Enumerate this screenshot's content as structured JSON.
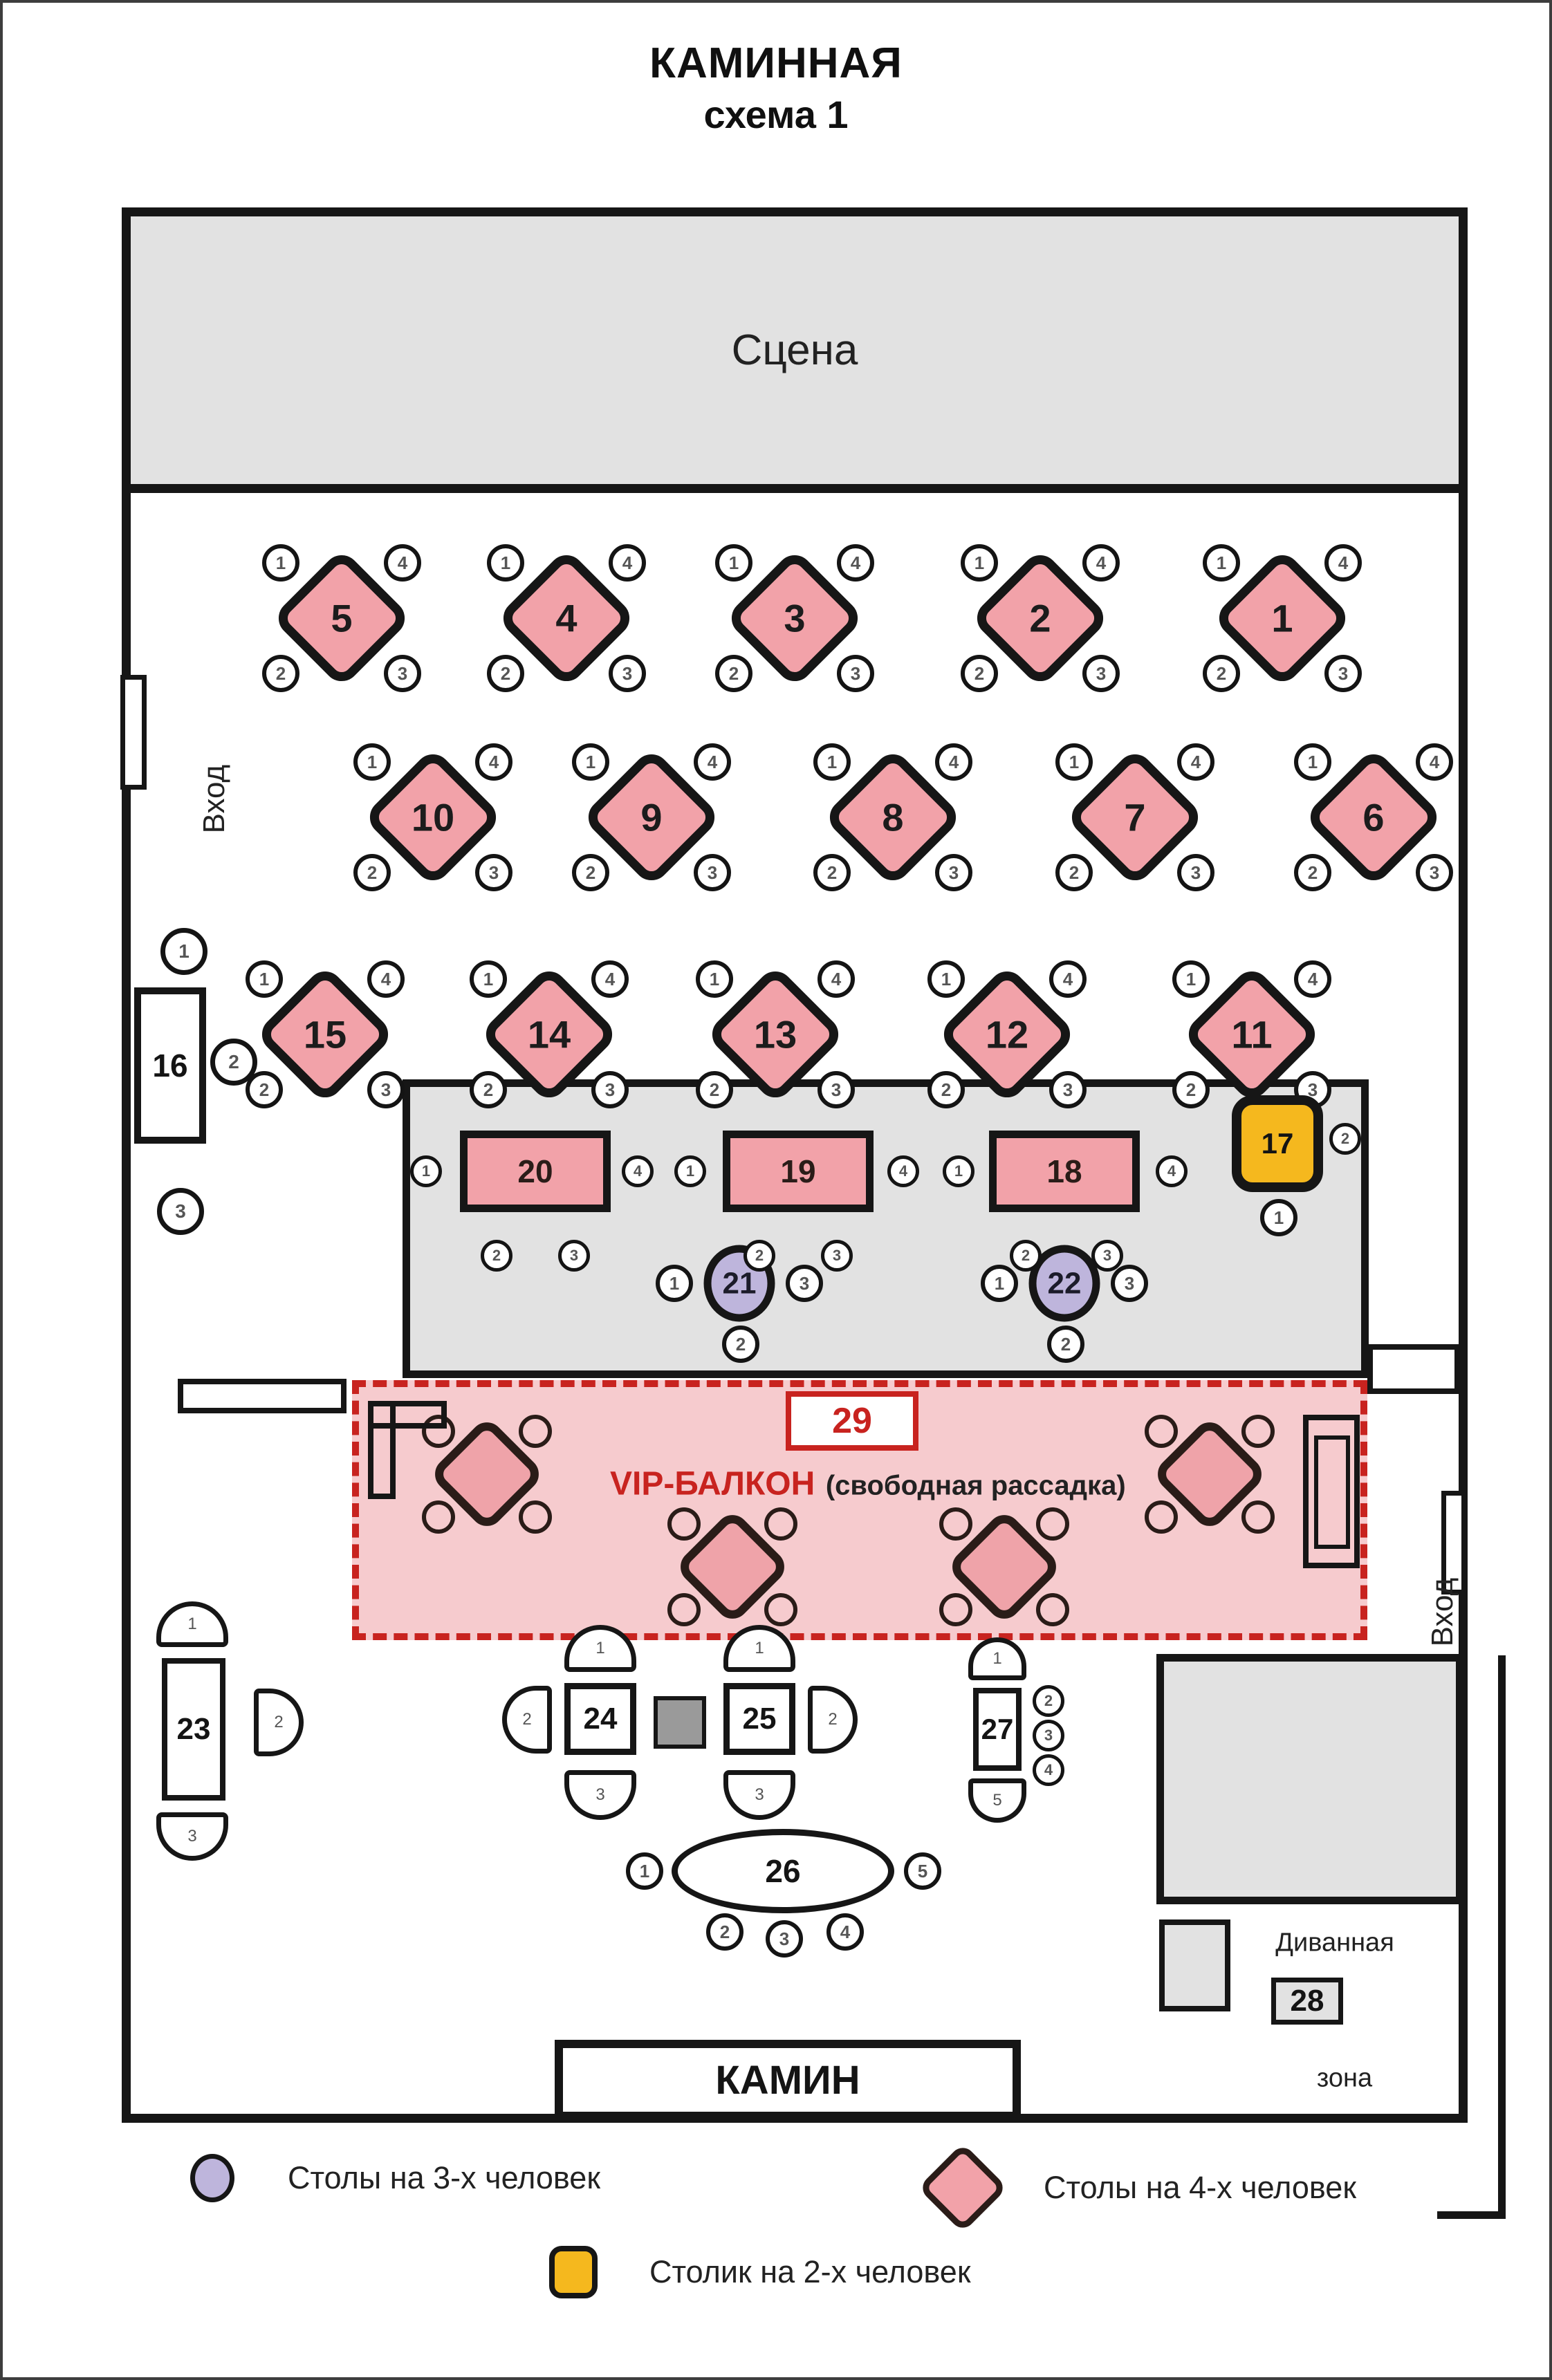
{
  "title": {
    "line1": "КАМИННАЯ",
    "line2": "схема 1"
  },
  "stage": {
    "label": "Сцена"
  },
  "entrance_left": {
    "label": "Вход"
  },
  "entrance_right": {
    "label": "Вход"
  },
  "fireplace": {
    "label": "КАМИН"
  },
  "vip_balcony": {
    "table_number": "29",
    "name": "VIP-БАЛКОН",
    "note": "(свободная рассадка)"
  },
  "sofa_zone": {
    "word_top": "Диванная",
    "table_number": "28",
    "word_bottom": "зона"
  },
  "seat_numbers": {
    "s1": "1",
    "s2": "2",
    "s3": "3",
    "s4": "4",
    "s5": "5"
  },
  "tables": {
    "t1": "1",
    "t2": "2",
    "t3": "3",
    "t4": "4",
    "t5": "5",
    "t6": "6",
    "t7": "7",
    "t8": "8",
    "t9": "9",
    "t10": "10",
    "t11": "11",
    "t12": "12",
    "t13": "13",
    "t14": "14",
    "t15": "15",
    "t16": "16",
    "t17": "17",
    "t18": "18",
    "t19": "19",
    "t20": "20",
    "t21": "21",
    "t22": "22",
    "t23": "23",
    "t24": "24",
    "t25": "25",
    "t26": "26",
    "t27": "27"
  },
  "legend": {
    "three_seat": {
      "label": "Столы на 3-х человек",
      "color": "#BEB5DC"
    },
    "four_seat": {
      "label": "Столы на 4-х человек",
      "color": "#F2A2A9"
    },
    "two_seat": {
      "label": "Столик на 2-х человек",
      "color": "#F5B81E"
    }
  },
  "colors": {
    "four_seat_table": "#F2A2A9",
    "three_seat_table": "#BEB5DC",
    "two_seat_table": "#F5B81E",
    "zone_gray": "#E2E2E2",
    "vip_background": "#F6CBCE",
    "vip_red": "#C8231F"
  }
}
